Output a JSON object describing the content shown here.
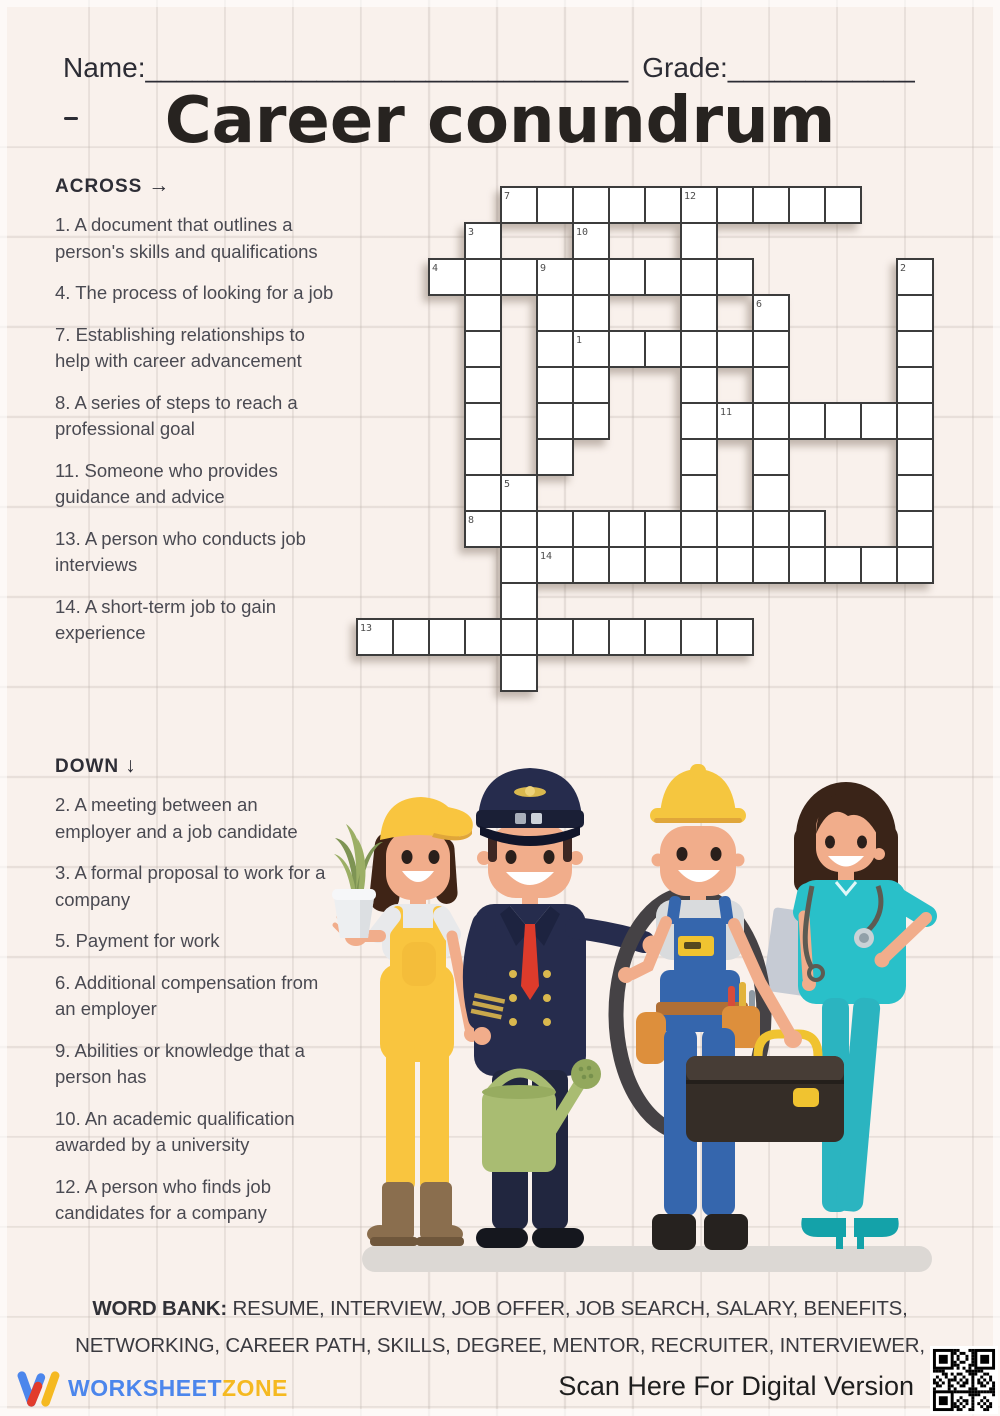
{
  "header": {
    "name_label": "Name:",
    "name_line": "_______________________________",
    "grade_label": "Grade:",
    "grade_line": "____________",
    "title": "Career conundrum"
  },
  "clues": {
    "across_heading": "ACROSS",
    "across_arrow": "→",
    "down_heading": "DOWN",
    "down_arrow": "↓",
    "across": [
      {
        "num": "1.",
        "text": "A document that outlines a person's skills and qualifications"
      },
      {
        "num": "4.",
        "text": "The process of looking for a job"
      },
      {
        "num": "7.",
        "text": "Establishing relationships to help with career advancement"
      },
      {
        "num": "8.",
        "text": "A series of steps to reach a professional goal"
      },
      {
        "num": "11.",
        "text": "Someone who provides guidance and advice"
      },
      {
        "num": "13.",
        "text": "A person who conducts job interviews"
      },
      {
        "num": "14.",
        "text": "A short-term job to gain experience"
      }
    ],
    "down": [
      {
        "num": "2.",
        "text": "A meeting between an employer and a job candidate"
      },
      {
        "num": "3.",
        "text": "A formal proposal to work for a company"
      },
      {
        "num": "5.",
        "text": "Payment for work"
      },
      {
        "num": "6.",
        "text": "Additional compensation from an employer"
      },
      {
        "num": "9.",
        "text": "Abilities or knowledge that a person has"
      },
      {
        "num": "10.",
        "text": "An academic qualification awarded by a university"
      },
      {
        "num": "12.",
        "text": "A person who finds job candidates for a company"
      }
    ]
  },
  "puzzle": {
    "cell_size": 36,
    "rows": 14,
    "cols": 16,
    "cells": [
      [
        0,
        4,
        "7"
      ],
      [
        0,
        5
      ],
      [
        0,
        6
      ],
      [
        0,
        7
      ],
      [
        0,
        8
      ],
      [
        0,
        9,
        "12"
      ],
      [
        0,
        10
      ],
      [
        0,
        11
      ],
      [
        0,
        12
      ],
      [
        0,
        13
      ],
      [
        1,
        3,
        "3"
      ],
      [
        1,
        6,
        "10"
      ],
      [
        1,
        9
      ],
      [
        2,
        2,
        "4"
      ],
      [
        2,
        3
      ],
      [
        2,
        4
      ],
      [
        2,
        5,
        "9"
      ],
      [
        2,
        6
      ],
      [
        2,
        7
      ],
      [
        2,
        8
      ],
      [
        2,
        9
      ],
      [
        2,
        10
      ],
      [
        2,
        15,
        "2"
      ],
      [
        3,
        3
      ],
      [
        3,
        5
      ],
      [
        3,
        6
      ],
      [
        3,
        9
      ],
      [
        3,
        11,
        "6"
      ],
      [
        3,
        15
      ],
      [
        4,
        3
      ],
      [
        4,
        5
      ],
      [
        4,
        6,
        "1"
      ],
      [
        4,
        7
      ],
      [
        4,
        8
      ],
      [
        4,
        9
      ],
      [
        4,
        10
      ],
      [
        4,
        11
      ],
      [
        4,
        15
      ],
      [
        5,
        3
      ],
      [
        5,
        5
      ],
      [
        5,
        6
      ],
      [
        5,
        9
      ],
      [
        5,
        11
      ],
      [
        5,
        15
      ],
      [
        6,
        3
      ],
      [
        6,
        5
      ],
      [
        6,
        6
      ],
      [
        6,
        9
      ],
      [
        6,
        10,
        "11"
      ],
      [
        6,
        11
      ],
      [
        6,
        12
      ],
      [
        6,
        13
      ],
      [
        6,
        14
      ],
      [
        6,
        15
      ],
      [
        7,
        3
      ],
      [
        7,
        5
      ],
      [
        7,
        9
      ],
      [
        7,
        11
      ],
      [
        7,
        15
      ],
      [
        8,
        3
      ],
      [
        8,
        4,
        "5"
      ],
      [
        8,
        9
      ],
      [
        8,
        11
      ],
      [
        8,
        15
      ],
      [
        9,
        3,
        "8"
      ],
      [
        9,
        4
      ],
      [
        9,
        5
      ],
      [
        9,
        6
      ],
      [
        9,
        7
      ],
      [
        9,
        8
      ],
      [
        9,
        9
      ],
      [
        9,
        10
      ],
      [
        9,
        11
      ],
      [
        9,
        12
      ],
      [
        9,
        15
      ],
      [
        10,
        4
      ],
      [
        10,
        5,
        "14"
      ],
      [
        10,
        6
      ],
      [
        10,
        7
      ],
      [
        10,
        8
      ],
      [
        10,
        9
      ],
      [
        10,
        10
      ],
      [
        10,
        11
      ],
      [
        10,
        12
      ],
      [
        10,
        13
      ],
      [
        10,
        14
      ],
      [
        10,
        15
      ],
      [
        11,
        4
      ],
      [
        12,
        0,
        "13"
      ],
      [
        12,
        1
      ],
      [
        12,
        2
      ],
      [
        12,
        3
      ],
      [
        12,
        4
      ],
      [
        12,
        5
      ],
      [
        12,
        6
      ],
      [
        12,
        7
      ],
      [
        12,
        8
      ],
      [
        12,
        9
      ],
      [
        12,
        10
      ],
      [
        13,
        4
      ]
    ]
  },
  "word_bank": {
    "label": "WORD BANK:",
    "line1": "RESUME, INTERVIEW, JOB OFFER, JOB SEARCH, SALARY, BENEFITS,",
    "line2": "NETWORKING, CAREER PATH, SKILLS, DEGREE, MENTOR, RECRUITER, INTERVIEWER,"
  },
  "footer": {
    "brand_part1": "WORKSHEET",
    "brand_part2": "ZONE",
    "scan_text": "Scan Here For Digital Version"
  },
  "colors": {
    "paper": "#F9F1EC",
    "grid_line_texture": "#BAB0AA",
    "cell_border": "#3C3C3C",
    "clue_text": "#4A4A52",
    "brand_blue": "#4C86EC",
    "brand_yellow": "#F5B921"
  }
}
